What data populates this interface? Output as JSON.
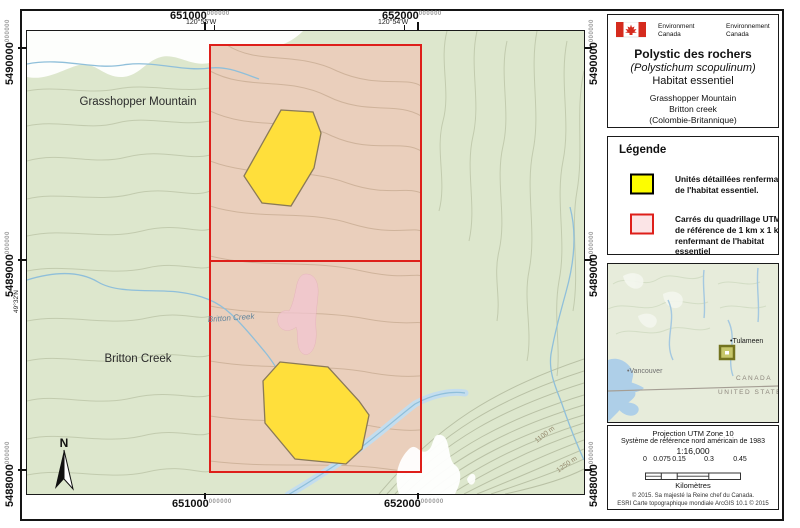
{
  "titleBlock": {
    "agency_en": [
      "Environment",
      "Canada"
    ],
    "agency_fr": [
      "Environnement",
      "Canada"
    ],
    "title": "Polystic des rochers",
    "subtitle_italic": "(Polystichum scopulinum)",
    "subtitle": "Habitat essentiel",
    "location": [
      "Grasshopper Mountain",
      "Britton creek",
      "(Colombie-Britannique)"
    ]
  },
  "legend": {
    "heading": "Légende",
    "item1_lines": [
      "Unités détaillées renfermant",
      "de l'habitat essentiel."
    ],
    "item2_lines": [
      "Carrés du quadrillage UTM",
      "de référence de 1 km x 1 km",
      "renfermant de l'habitat essentiel"
    ]
  },
  "inset": {
    "town": "•Tulameen",
    "city": "•Vancouver",
    "country_top": "CANADA",
    "country_bottom": "UNITED STATES"
  },
  "info": {
    "projection_line1": "Projection UTM Zone 10",
    "projection_line2": "Système de référence nord américain de 1983",
    "scale_ratio": "1:16,000",
    "scalebar_labels": [
      "0",
      "0.075",
      "0.15",
      "0.3",
      "0.45"
    ],
    "scalebar_unit": "Kilomètres",
    "copyright_line1": "© 2015. Sa majesté la Reine chef du Canada.",
    "copyright_line2": "ESRI Carte topographique mondiale ArcGIS 10.1 © 2015"
  },
  "map": {
    "labels": {
      "mountain": "Grasshopper Mountain",
      "creek_area": "Britton Creek",
      "creek_stream": "Britton Creek",
      "contour_1": "1100 m",
      "contour_2": "1250 m",
      "north": "N"
    },
    "grid": {
      "eastings": [
        {
          "big": "651000",
          "zeros": "000000"
        },
        {
          "big": "652000",
          "zeros": "000000"
        }
      ],
      "northings": [
        {
          "big": "5490000",
          "zeros": "000000"
        },
        {
          "big": "5489000",
          "zeros": "000000"
        },
        {
          "big": "5488000",
          "zeros": "000000"
        }
      ],
      "longitudes": [
        "120°55'W",
        "120°54'W"
      ],
      "latitude": "49°32'N"
    }
  },
  "colors": {
    "habitat_yellow": "#ffdf3b",
    "legend_yellow": "#fdfd00",
    "grid_red": "#de1f1a",
    "legend_pink_fill": "#fbe4e6",
    "square_tint": "#e9d5c0",
    "topo_green": "#dde7cd",
    "water_blue": "#8fbfda",
    "pink_blob": "#f3c6d3"
  }
}
